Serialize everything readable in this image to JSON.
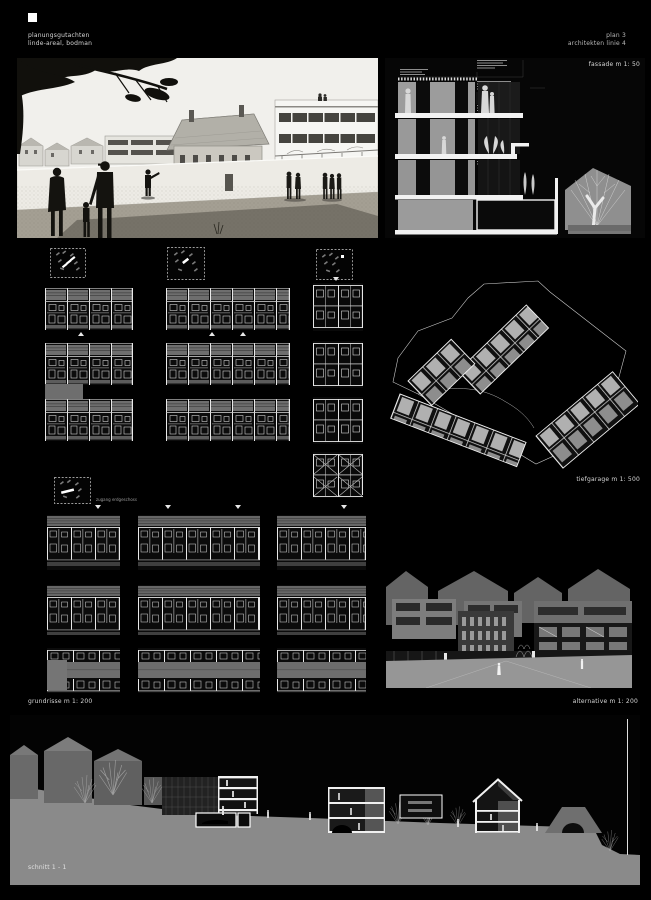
{
  "header": {
    "project_line1": "planungsgutachten",
    "project_line2": "linde-areal, bodman",
    "plan_line1": "plan 3",
    "plan_line2": "architekten linie 4"
  },
  "sections": {
    "fassade_label": "fassade m 1: 50",
    "tiefgarage_label": "tiefgarage m 1: 500",
    "grundrisse_label": "grundrisse m 1: 200",
    "alternative_label": "alternative m 1: 200",
    "schnitt_label": "schnitt 1 - 1",
    "plan_note": "zugang erdgeschoss"
  },
  "colors": {
    "background": "#000000",
    "text_light": "#d6d6d6",
    "drawing_gray": "#8a8a8a",
    "paper_light": "#f1f0ec",
    "accent_white": "#ffffff"
  }
}
